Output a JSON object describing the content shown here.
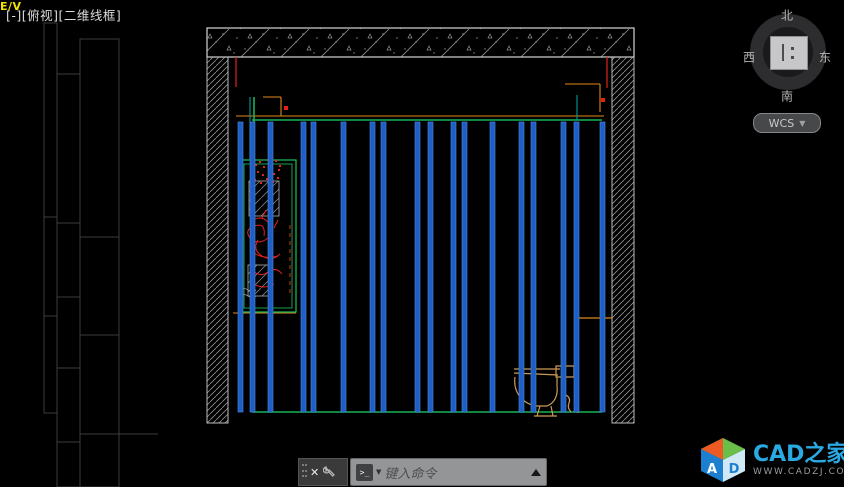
{
  "viewport": {
    "label": "[-][俯视][二维线框]"
  },
  "viewcube": {
    "north": "北",
    "west": "西",
    "east": "东",
    "south": "南",
    "wcs_label": "WCS",
    "chevron": "▼"
  },
  "drawing": {
    "ev_label": "E/V"
  },
  "ucs": {
    "x": "X",
    "y": "Y"
  },
  "command_dock": {
    "close": "✕",
    "prompt_icon": ">_",
    "caret": "▼",
    "placeholder": "键入命令"
  },
  "logo": {
    "brand": "CAD之家",
    "site": "WWW.CADZJ.COM",
    "cube_letter_a": "A",
    "cube_letter_d": "D"
  },
  "colors": {
    "stud": "#1f5ec4",
    "stud_edge": "#4e8ae8",
    "grip": "#1286e0",
    "cyan": "#27c8ee",
    "green": "#19b353",
    "teal": "#00a8a8",
    "red": "#e32119",
    "orange": "#e08818",
    "tan": "#cd9a55",
    "yellow": "#f2e203",
    "hatch": "#929292",
    "band_stroke": "#d6d6d6",
    "wall_stroke": "#d0d0d0",
    "panel": "#3d3d3f",
    "white": "#f2f2f2",
    "gray_detail": "#a9a9a9"
  },
  "geometry": {
    "top_band": [
      207,
      28,
      427,
      29
    ],
    "left_wall": [
      207,
      57,
      21,
      366
    ],
    "right_wall": [
      612,
      57,
      22,
      366
    ],
    "ground": [
      185,
      422,
      473,
      5
    ],
    "ground_hatch": [
      [
        193,
        427,
        42,
        8
      ],
      [
        600,
        427,
        52,
        8
      ]
    ],
    "red_lines": [
      [
        236,
        57,
        236,
        87
      ],
      [
        607,
        57,
        607,
        88
      ]
    ],
    "red_dots": [
      [
        603,
        100
      ],
      [
        286,
        108
      ]
    ],
    "orange_lines": [
      [
        236,
        116,
        604,
        116
      ],
      [
        263,
        97,
        281,
        97
      ],
      [
        281,
        97,
        281,
        116
      ],
      [
        565,
        84,
        600,
        84
      ],
      [
        600,
        84,
        600,
        112
      ],
      [
        233,
        313,
        296,
        313
      ]
    ],
    "green_lines": [
      [
        252,
        120,
        602,
        120
      ],
      [
        252,
        412,
        602,
        412
      ],
      [
        254,
        97,
        254,
        160
      ]
    ],
    "teal_lines": [
      [
        250,
        97,
        250,
        160
      ],
      [
        577,
        95,
        577,
        120
      ]
    ],
    "studs": {
      "xs": [
        238,
        250,
        268,
        301,
        311,
        341,
        370,
        381,
        415,
        428,
        451,
        462,
        490,
        519,
        531,
        561,
        574,
        600
      ],
      "w": 5,
      "y1": 122,
      "y2": 412
    },
    "block_rows": [
      128,
      152,
      176,
      218,
      260,
      302,
      344,
      370,
      396
    ],
    "block_h": 5,
    "niche": {
      "outer": [
        240,
        160,
        56,
        152
      ],
      "inner": [
        244,
        164,
        48,
        144
      ],
      "panel1": [
        249,
        181,
        30,
        35
      ],
      "panel2": [
        248,
        265,
        24,
        31
      ]
    },
    "red_dot_cluster": [
      [
        256,
        165
      ],
      [
        260,
        162
      ],
      [
        264,
        167
      ],
      [
        268,
        160
      ],
      [
        272,
        164
      ],
      [
        276,
        161
      ],
      [
        280,
        166
      ],
      [
        258,
        172
      ],
      [
        263,
        175
      ],
      [
        269,
        171
      ],
      [
        274,
        174
      ],
      [
        279,
        170
      ],
      [
        255,
        180
      ],
      [
        261,
        183
      ],
      [
        267,
        179
      ],
      [
        273,
        182
      ],
      [
        278,
        178
      ]
    ],
    "plant_paths": [
      "M250,222 q10,-8 18,0 q8,8 0,16 q-10,8 -18,0 q-6,-8 4,-12 q12,-4 10,10",
      "M258,240 q-6,10 4,16 q10,6 18,-2",
      "M252,252 q12,8 26,4",
      "M262,218 l4,-8 M270,216 l-1,10 M278,220 l-4,8",
      "M252,270 q8,8 16,2 q8,-6 14,2 M254,284 q10,6 20,0"
    ],
    "red_dashed": [
      290,
      225,
      290,
      295
    ],
    "gray_waves": "M240,290 q4,-3 8,0 q4,3 8,0 M240,296 q4,-3 8,0 q4,3 8,0",
    "counter": {
      "bg": [
        230,
        312,
        68,
        105
      ],
      "green": [
        233,
        312,
        63,
        104
      ],
      "yellow_band": [
        237,
        352,
        56,
        11
      ],
      "orange_v": [
        234,
        313,
        234,
        416
      ],
      "red_v": [
        231,
        313,
        231,
        416
      ],
      "fixture_lines_y": [
        322,
        326,
        330,
        334,
        338
      ],
      "fixture_x": [
        240,
        292
      ],
      "texture": [
        "M238,370 q16,12 10,26 q-4,12 8,20",
        "M252,368 q20,18 30,40",
        "M272,374 q8,18 20,28"
      ]
    },
    "toilet_paths": [
      "M514,369 L560,369",
      "M514,373 L558,375",
      "M556,366 L574,366 L574,377 L556,377 Z",
      "M515,377 C513,391 521,403 536,406 L547,406 C555,403 558,395 557,386 L557,377",
      "M540,406 L537,416 M551,406 L553,416",
      "M534,416 L557,416",
      "M566,395 q5,3 3,8 q-2,5 2,9"
    ],
    "pipe": [
      [
        578,
        318,
        612,
        318
      ],
      [
        578,
        318,
        578,
        413
      ]
    ],
    "yellow_fixture": {
      "outer": [
        511,
        315,
        39,
        21
      ],
      "inner": [
        514,
        318,
        33,
        15
      ]
    },
    "vent": {
      "box": [
        545,
        85,
        27,
        26
      ],
      "arcs": [
        "M572,92 q14,4 20,12",
        "M572,98 q12,6 16,12"
      ],
      "leader": [
        536,
        91,
        544,
        95
      ]
    },
    "grips": [
      [
        237,
        91
      ],
      [
        263,
        91
      ],
      [
        577,
        93
      ],
      [
        604,
        91
      ],
      [
        577,
        121
      ],
      [
        237,
        223
      ],
      [
        240,
        315
      ],
      [
        289,
        315
      ],
      [
        289,
        413
      ],
      [
        604,
        413
      ]
    ],
    "grip_size": 10,
    "arrow_down": [
      590,
      92
    ],
    "arrow_left": [
      232,
      413
    ],
    "white_box": [
      670,
      391,
      26,
      24
    ],
    "right_ruler": {
      "x": 841,
      "y1": 27,
      "y2": 302,
      "step": 15
    },
    "left_panels": {
      "cols": [
        {
          "x": 44,
          "w": 13,
          "y1": 23,
          "y2": 413,
          "divs": [
            217,
            316
          ]
        },
        {
          "x": 57,
          "w": 23,
          "y1": 74,
          "y2": 487,
          "divs": [
            223,
            297,
            368,
            442
          ]
        },
        {
          "x": 80,
          "w": 39,
          "y1": 39,
          "y2": 487,
          "divs": [
            237,
            335,
            434
          ]
        }
      ],
      "ext_line": [
        119,
        434,
        158,
        434
      ]
    },
    "ucs": {
      "vline": [
        38,
        421,
        38,
        466
      ],
      "hline": [
        46,
        473,
        94,
        473
      ],
      "origin": [
        31,
        466,
        15,
        15
      ],
      "y_pos": [
        57,
        407
      ],
      "x_pos": [
        76,
        462
      ]
    },
    "ev_pos": [
      511,
      83
    ]
  }
}
